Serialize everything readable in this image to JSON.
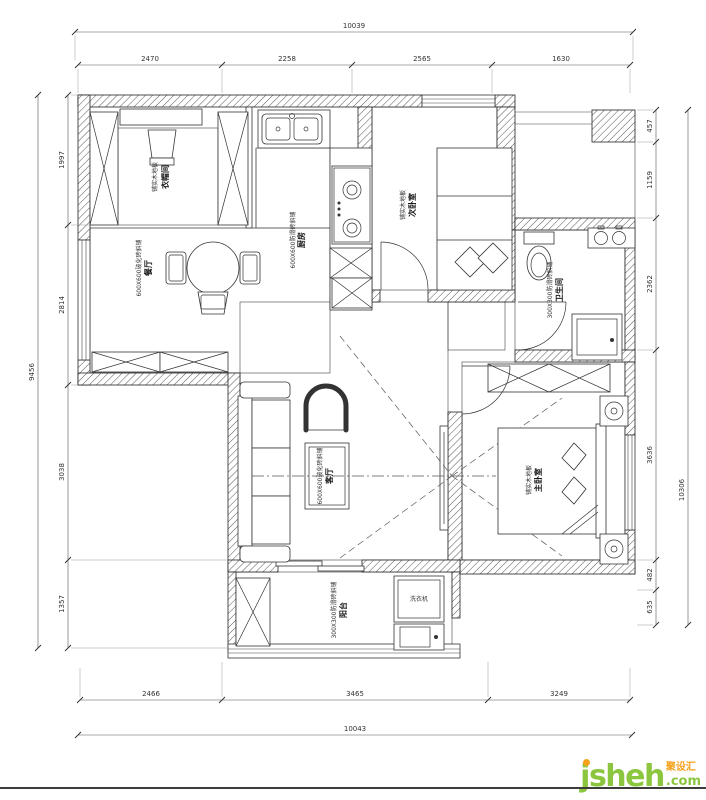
{
  "colors": {
    "ink": "#333333",
    "grid": "#8a8a8a",
    "watermark_green": "#8cc63f",
    "watermark_orange": "#f5a11c"
  },
  "dimensions": {
    "top": {
      "total": "10039",
      "segments": [
        "2470",
        "2258",
        "2565",
        "1630"
      ]
    },
    "bottom": {
      "total": "10043",
      "segments": [
        "2466",
        "3465",
        "3249"
      ]
    },
    "left": {
      "total": "9456",
      "segments": [
        "1997",
        "2814",
        "3038",
        "1357"
      ]
    },
    "right": {
      "total": "10306",
      "segments": [
        "457",
        "1159",
        "2362",
        "3636",
        "482",
        "635"
      ]
    }
  },
  "rooms": {
    "cloakroom": {
      "name": "衣帽间",
      "finish": "铺实木地板"
    },
    "kitchen": {
      "name": "厨房",
      "finish": "600X600防滑砖斜铺"
    },
    "secondary_bedroom": {
      "name": "次卧室",
      "finish": "铺实木地板"
    },
    "bathroom": {
      "name": "卫生间",
      "finish": "300X300防滑砖斜铺"
    },
    "dining": {
      "name": "餐厅",
      "finish": "600X600玻化砖斜铺"
    },
    "living": {
      "name": "客厅",
      "finish": "600X600玻化砖斜铺"
    },
    "master_bedroom": {
      "name": "主卧室",
      "finish": "铺实木地板"
    },
    "balcony": {
      "name": "阳台",
      "finish": "300X300防滑砖斜铺"
    }
  },
  "appliances": {
    "washing_machine": "洗衣机"
  },
  "watermark": {
    "brand": "jsheh",
    "suffix": ".com",
    "badge": "聚设汇"
  }
}
